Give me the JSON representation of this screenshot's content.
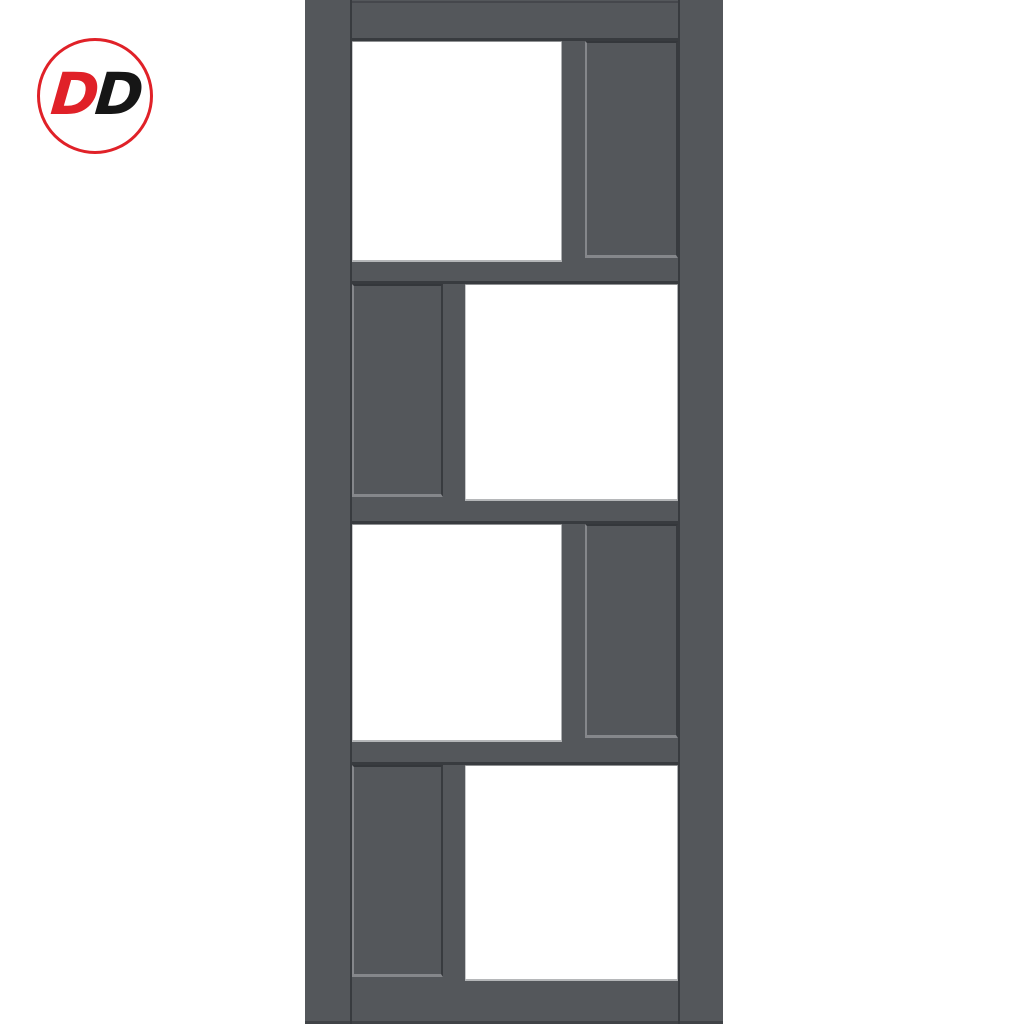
{
  "page": {
    "kind": "product-image",
    "subject": "dark grey door with four rows of offset square panels, one glazed and one solid panel per row"
  },
  "theme": {
    "background": "#ffffff",
    "frame": "#54575b",
    "lineDark": "#383b3f",
    "panelShadow": "#34373b",
    "edgeLight": "#85878b",
    "glass": "#ffffff",
    "glassEdge": "#b5b7b9",
    "logoRed": "#e02128",
    "logoBlack": "#161616"
  },
  "logo": {
    "text": "DD",
    "letters": [
      {
        "char": "D",
        "color": "#e02128"
      },
      {
        "char": "D",
        "color": "#161616"
      }
    ],
    "ring_color": "#e02128",
    "shape": "circle"
  },
  "door": {
    "frame_color": "#54575b",
    "glass_color": "#ffffff",
    "row_count": 4,
    "panels_per_row": 2,
    "rows": [
      {
        "glass_side": "left",
        "solid_side": "right"
      },
      {
        "glass_side": "right",
        "solid_side": "left"
      },
      {
        "glass_side": "left",
        "solid_side": "right"
      },
      {
        "glass_side": "right",
        "solid_side": "left"
      }
    ]
  }
}
